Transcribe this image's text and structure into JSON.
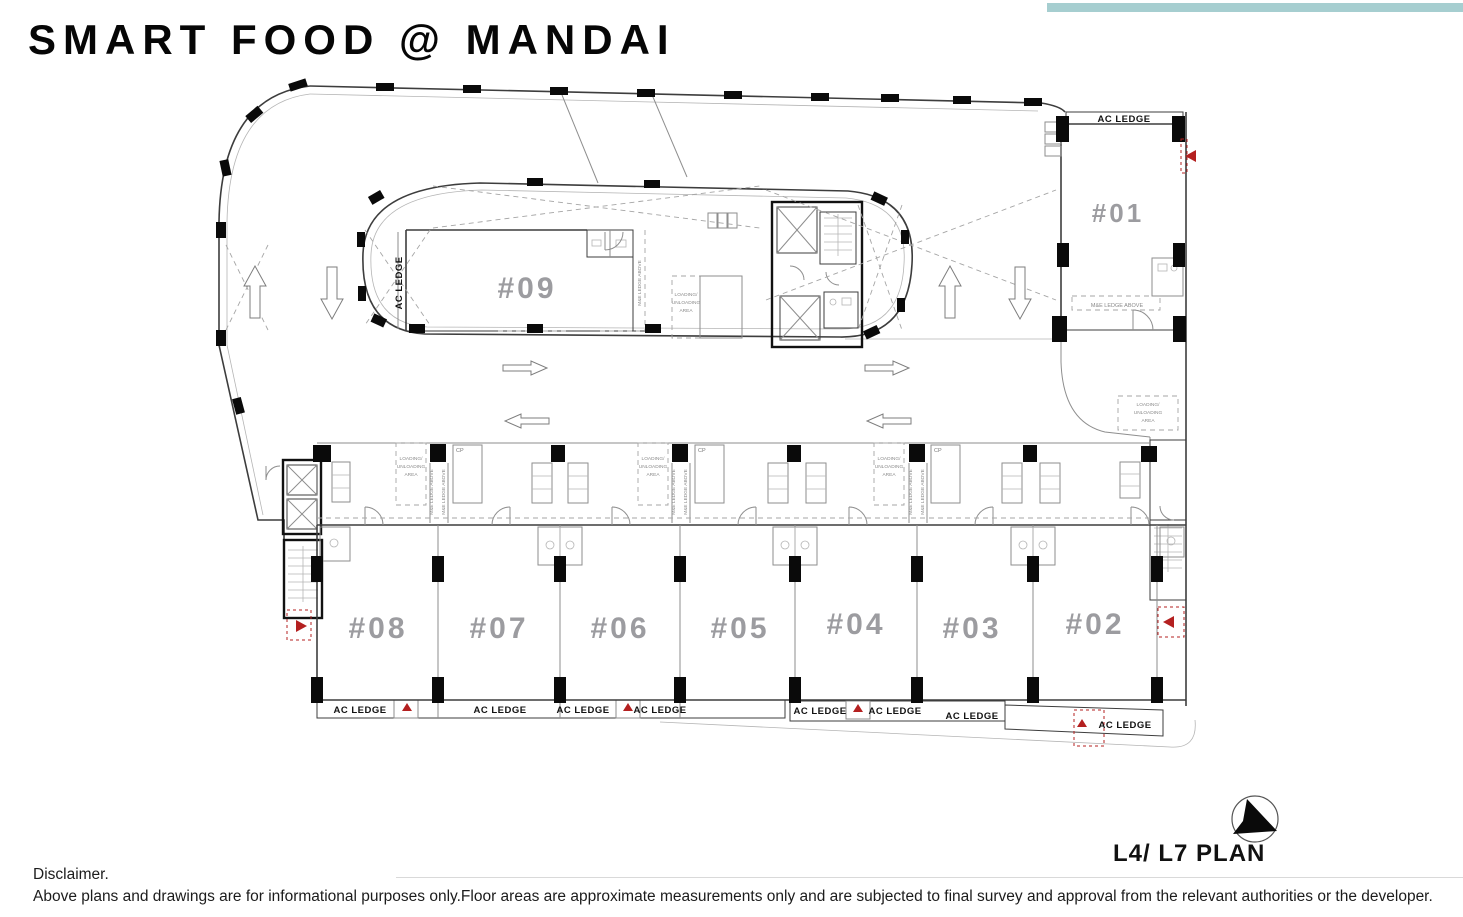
{
  "header": {
    "title": "SMART FOOD @ MANDAI"
  },
  "colors": {
    "accent_bar": "#a6ced0",
    "unit_label": "#9c9ca0",
    "marker_red": "#b42020"
  },
  "plan": {
    "label": "L4/ L7 PLAN",
    "units": [
      {
        "id": "#01"
      },
      {
        "id": "#02"
      },
      {
        "id": "#03"
      },
      {
        "id": "#04"
      },
      {
        "id": "#05"
      },
      {
        "id": "#06"
      },
      {
        "id": "#07"
      },
      {
        "id": "#08"
      },
      {
        "id": "#09"
      }
    ],
    "labels": {
      "ac_ledge": "AC LEDGE",
      "me_ledge": "M&E LEDGE ABOVE",
      "cp": "CP",
      "loading_lines": [
        "LOADING/",
        "UNLOADING",
        "AREA"
      ]
    }
  },
  "footer": {
    "disclaimer_heading": "Disclaimer.",
    "disclaimer_body": "Above plans and drawings are for informational purposes only.Floor areas are approximate measurements only and are subjected to final survey and approval from the relevant authorities or the developer."
  }
}
